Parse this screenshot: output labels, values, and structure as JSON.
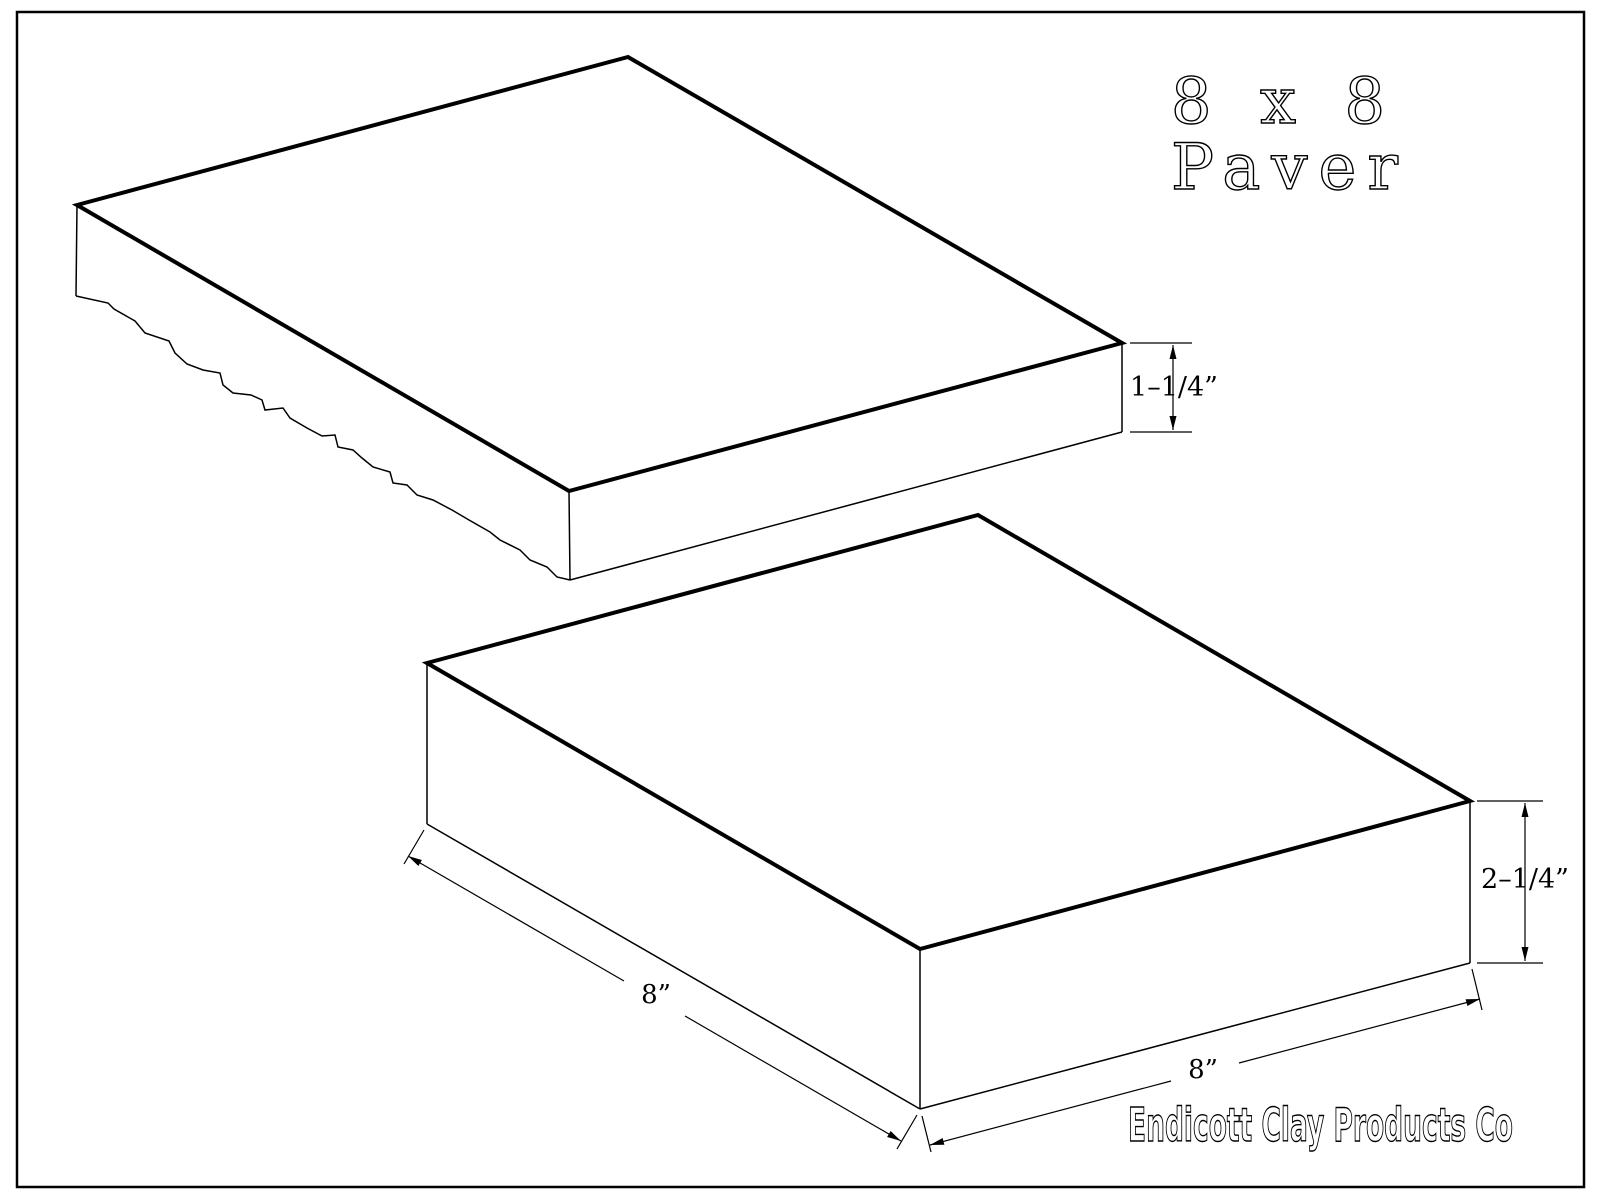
{
  "drawing": {
    "background_color": "#ffffff",
    "line_color": "#000000",
    "title_line1": "8 x 8",
    "title_line2": "Paver",
    "dimensions": {
      "top_paver_thickness": "1–1/4”",
      "bottom_paver_thickness": "2–1/4”",
      "bottom_paver_left_edge": "8”",
      "bottom_paver_right_edge": "8”"
    },
    "logo_text": "Endicott Clay Products Co"
  }
}
